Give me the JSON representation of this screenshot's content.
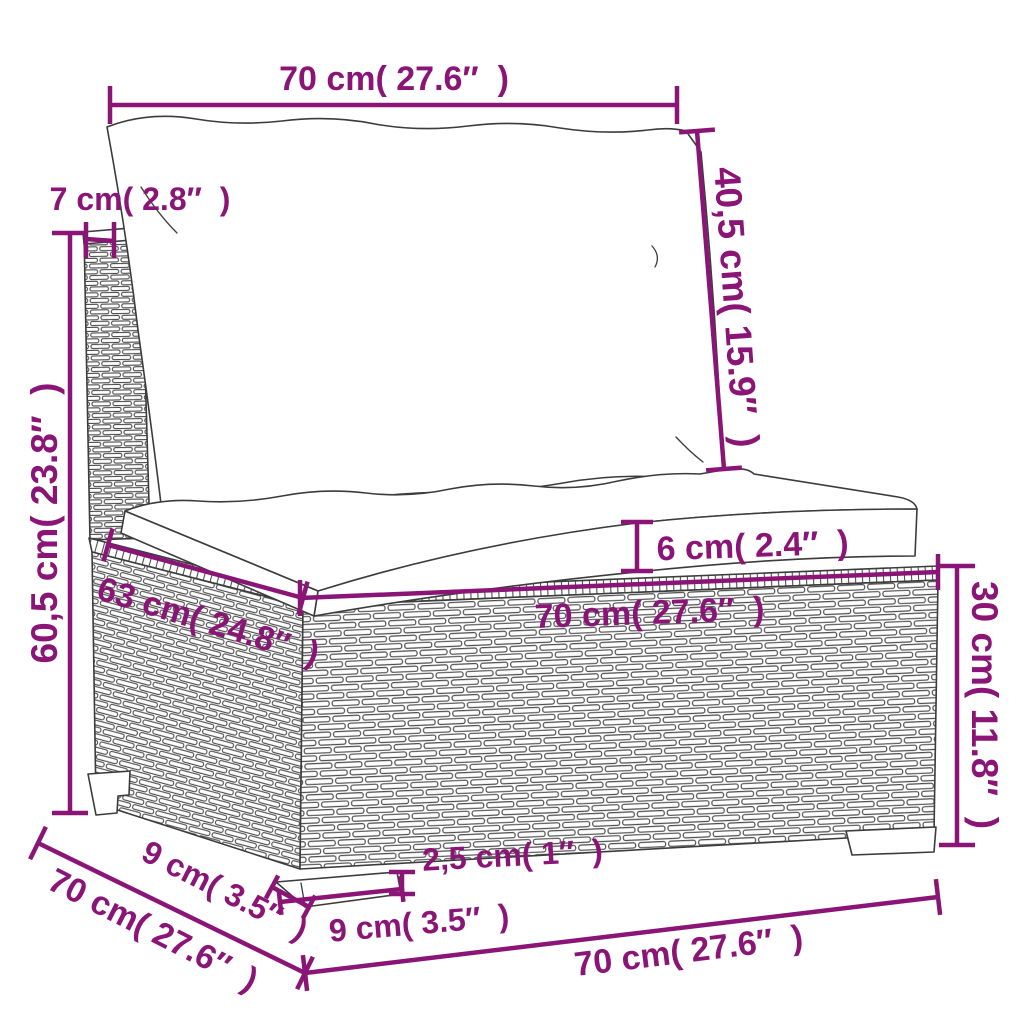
{
  "colors": {
    "accent": "#8a1577",
    "outline": "#3c3c3c",
    "background": "#ffffff"
  },
  "labels": {
    "top_width": "70 cm( 27.6″  )",
    "back_cushion_height": "40,5 cm( 15.9″  )",
    "back_panel_thickness": "7 cm( 2.8″  )",
    "overall_height": "60,5 cm( 23.8″  )",
    "seat_cushion_thickness": "6 cm( 2.4″  )",
    "inner_seat_depth": "63 cm( 24.8″  )",
    "seat_width": "70 cm( 27.6″  )",
    "base_height": "30 cm( 11.8″  )",
    "overall_depth": "70 cm( 27.6″  )",
    "leg_depth": "9 cm( 3.5″  )",
    "leg_height": "2,5 cm( 1″  )",
    "leg_width": "9 cm( 3.5″  )",
    "base_width": "70 cm( 27.6″  )"
  }
}
